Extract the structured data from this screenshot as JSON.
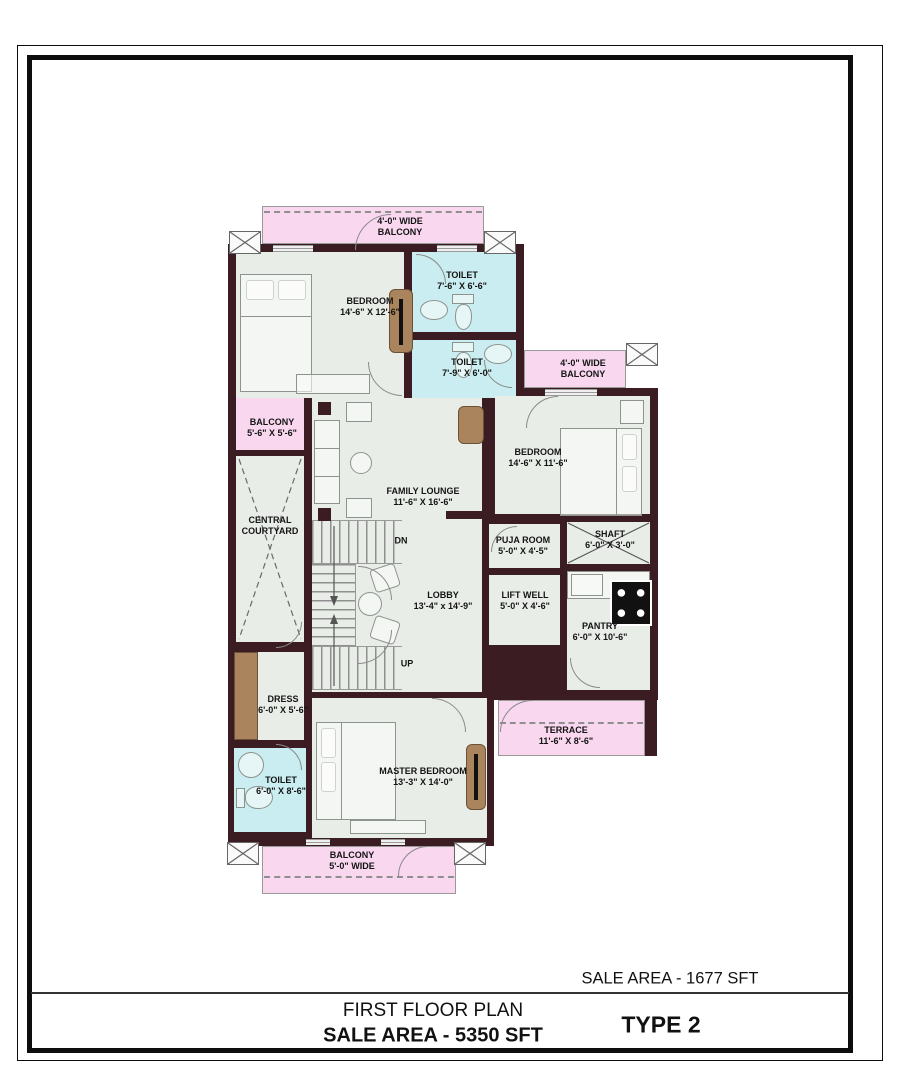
{
  "title_block": {
    "floor_sale_area": "SALE AREA - 1677 SFT",
    "plan_title": "FIRST FLOOR PLAN",
    "total_sale_area": "SALE AREA - 5350 SFT",
    "type_label": "TYPE 2"
  },
  "rooms": {
    "balcony_top": {
      "name": "4'-0\" WIDE",
      "dims": "BALCONY"
    },
    "bedroom_1": {
      "name": "BEDROOM",
      "dims": "14'-6\" X 12'-6\""
    },
    "toilet_1": {
      "name": "TOILET",
      "dims": "7'-6\" X 6'-6\""
    },
    "toilet_2": {
      "name": "TOILET",
      "dims": "7'-9\" X 6'-0\""
    },
    "balcony_left": {
      "name": "BALCONY",
      "dims": "5'-6\" X 5'-6\""
    },
    "central_courtyard": {
      "name": "CENTRAL",
      "dims": "COURTYARD"
    },
    "family_lounge": {
      "name": "FAMILY LOUNGE",
      "dims": "11'-6\" X 16'-6\""
    },
    "bedroom_2": {
      "name": "BEDROOM",
      "dims": "14'-6\" X 11'-6\""
    },
    "balcony_right": {
      "name": "4'-0\" WIDE",
      "dims": "BALCONY"
    },
    "puja_room": {
      "name": "PUJA ROOM",
      "dims": "5'-0\" X 4'-5\""
    },
    "shaft": {
      "name": "SHAFT",
      "dims": "6'-0\" X 3'-0\""
    },
    "lift_well": {
      "name": "LIFT WELL",
      "dims": "5'-0\" X 4'-6\""
    },
    "pantry": {
      "name": "PANTRY",
      "dims": "6'-0\" X 10'-6\""
    },
    "lobby": {
      "name": "LOBBY",
      "dims": "13'-4\" x 14'-9\""
    },
    "dress": {
      "name": "DRESS",
      "dims": "6'-0\" X 5'-6\""
    },
    "toilet_3": {
      "name": "TOILET",
      "dims": "6'-0\" X 8'-6\""
    },
    "master_bedroom": {
      "name": "MASTER BEDROOM",
      "dims": "13'-3\" X 14'-0\""
    },
    "terrace": {
      "name": "TERRACE",
      "dims": "11'-6\" X 8'-6\""
    },
    "balcony_bottom": {
      "name": "BALCONY",
      "dims": "5'-0\" WIDE"
    }
  },
  "stairs": {
    "down_label": "DN",
    "up_label": "UP"
  },
  "colors": {
    "wall": "#3a1c22",
    "floor": "#e9ede8",
    "balcony": "#f8d7ef",
    "toilet": "#c9edf0",
    "wood": "#a9845c"
  }
}
